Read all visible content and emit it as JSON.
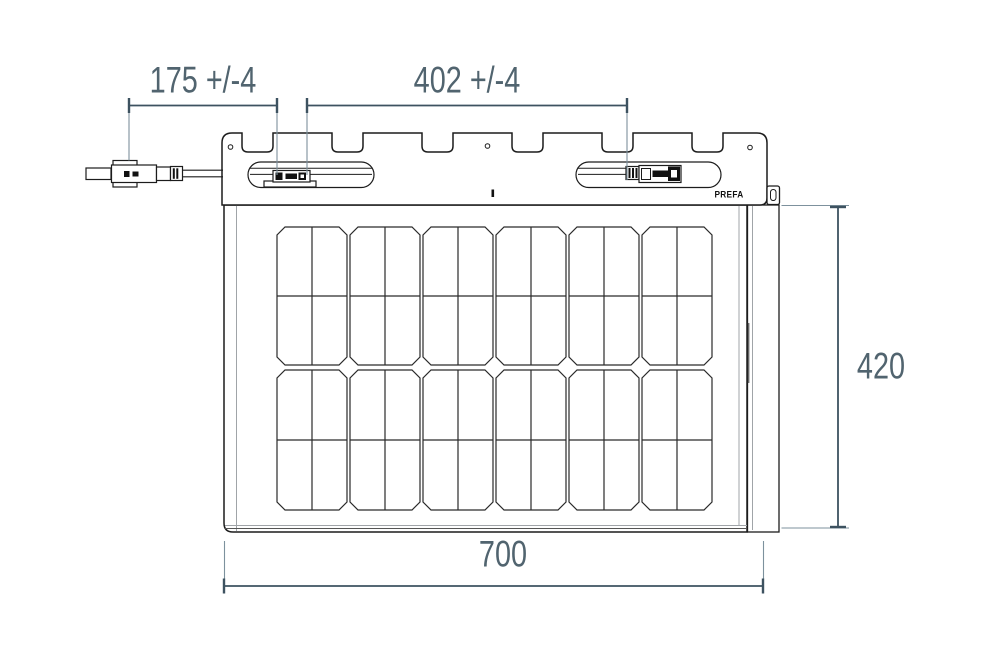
{
  "drawing": {
    "type": "technical-dimension-drawing",
    "subject": "PREFA solar roof panel, front view",
    "brand": "PREFA",
    "dimensions": {
      "top_left": {
        "label": "175 +/-4",
        "value": 175,
        "tolerance": "+/-4"
      },
      "top_right": {
        "label": "402 +/-4",
        "value": 402,
        "tolerance": "+/-4"
      },
      "right": {
        "label": "420",
        "value": 420
      },
      "bottom": {
        "label": "700",
        "value": 700
      }
    },
    "solar_cells": {
      "column_groups": 6,
      "row_bands": 2,
      "half_cells_per_group": 4,
      "total_half_cells": 48
    },
    "features": {
      "mounting_notches": 6,
      "screw_holes": 3,
      "cable_slots": 2,
      "connector": "solar plug connector on left cable"
    }
  },
  "colors": {
    "background": "#ffffff",
    "outline": "#1c1c1c",
    "inner_line": "#a0a4a8",
    "cell_line": "#2a2a2a",
    "dimension_line": "#3d5260",
    "extension_line": "#7d919d",
    "dimension_text": "#51646f"
  }
}
